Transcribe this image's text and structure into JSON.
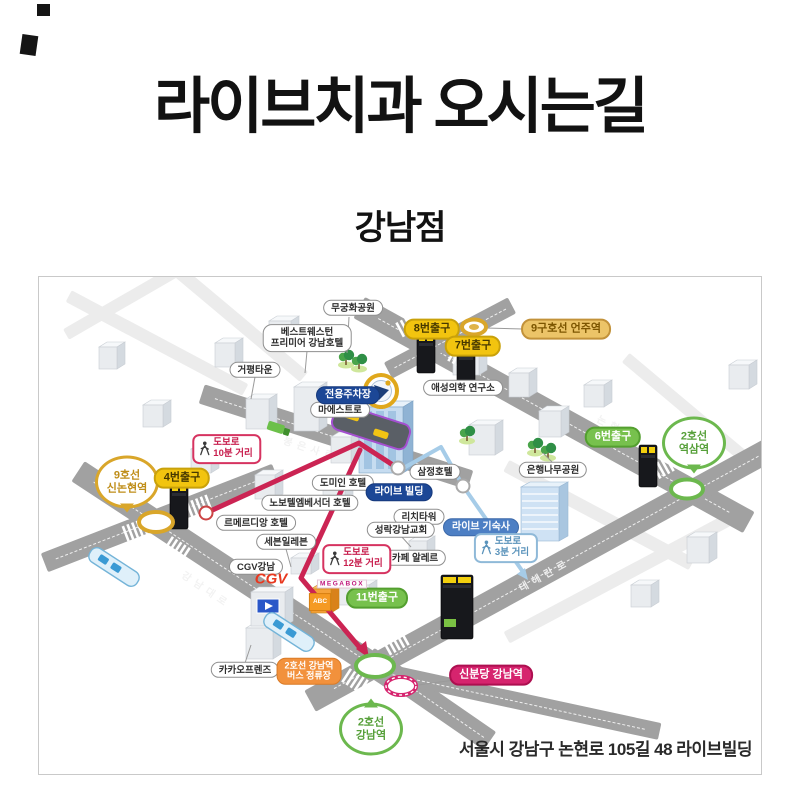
{
  "page": {
    "title": "라이브치과 오시는길",
    "subtitle": "강남점",
    "address": "서울시 강남구 논현로 105길 48 라이브빌딩"
  },
  "colors": {
    "route_primary": "#cb2453",
    "route_secondary": "#a6cce8",
    "road": "#a1a1a1",
    "subway_yellow": "#d9a62a",
    "subway_green": "#6cb84e",
    "subway_magenta": "#d6246e"
  },
  "map": {
    "roads": [
      {
        "id": "nonhyeon-ro",
        "label": "논현로"
      },
      {
        "id": "bongeunsa-ro",
        "label": "봉은사로"
      },
      {
        "id": "gangnam-daero",
        "label": "강남대로"
      },
      {
        "id": "teheran-ro",
        "label": "테헤란로"
      }
    ],
    "stations": [
      {
        "id": "sinnonhyeon",
        "name": "9호선 신논현역",
        "display": "balloon",
        "lines": [
          "9호선",
          "신논현역"
        ],
        "style": "gold",
        "tail": "down"
      },
      {
        "id": "eonju",
        "name": "9구호선 언주역",
        "display": "badge",
        "style": "gold"
      },
      {
        "id": "yeoksam",
        "name": "2호선 역삼역",
        "display": "balloon",
        "lines": [
          "2호선",
          "역삼역"
        ],
        "style": "green",
        "tail": "down"
      },
      {
        "id": "gangnam",
        "name": "2호선 강남역",
        "display": "balloon",
        "lines": [
          "2호선",
          "강남역"
        ],
        "style": "green",
        "tail": "up"
      },
      {
        "id": "sinbundang-gangnam",
        "name": "신분당 강남역",
        "display": "badge",
        "style": "crimson"
      }
    ],
    "exits": [
      {
        "id": "exit-4",
        "label": "4번출구",
        "style": "yellow"
      },
      {
        "id": "exit-8",
        "label": "8번출구",
        "style": "yellow"
      },
      {
        "id": "exit-7",
        "label": "7번출구",
        "style": "yellow"
      },
      {
        "id": "exit-6",
        "label": "6번출구",
        "style": "green"
      },
      {
        "id": "exit-11",
        "label": "11번출구",
        "style": "green"
      }
    ],
    "destination_badges": [
      {
        "id": "parking",
        "label": "전용주차장",
        "style": "navy"
      },
      {
        "id": "live-building",
        "label": "라이브 빌딩",
        "style": "navy"
      },
      {
        "id": "live-dorm",
        "label": "라이브 기숙사",
        "style": "steel"
      }
    ],
    "walk_routes": [
      {
        "id": "walk-10",
        "lines": [
          "도보로",
          "10분 거리"
        ],
        "style": "red"
      },
      {
        "id": "walk-12",
        "lines": [
          "도보로",
          "12분 거리"
        ],
        "style": "red"
      },
      {
        "id": "walk-3",
        "lines": [
          "도보로",
          "3분 거리"
        ],
        "style": "blue"
      }
    ],
    "landmarks": [
      {
        "id": "mugunghwa-park",
        "label": "무궁화공원"
      },
      {
        "id": "best-western",
        "lines": [
          "베스트웨스턴",
          "프리미어 강남호텔"
        ]
      },
      {
        "id": "geopyeong-town",
        "label": "거평타운"
      },
      {
        "id": "maestro",
        "label": "마에스트로"
      },
      {
        "id": "aeseong-lab",
        "label": "애성의학 연구소"
      },
      {
        "id": "dormy-inn",
        "label": "도미인 호텔"
      },
      {
        "id": "novotel",
        "label": "노보텔엠베서더 호텔"
      },
      {
        "id": "le-meridien",
        "label": "르메르디앙 호텔"
      },
      {
        "id": "seven-eleven",
        "label": "세븐일레븐"
      },
      {
        "id": "cgv-gangnam",
        "label": "CGV강남"
      },
      {
        "id": "samjung-hotel",
        "label": "삼정호텔"
      },
      {
        "id": "ginkgo-park",
        "label": "은행나무공원"
      },
      {
        "id": "rich-tower",
        "label": "리치타워"
      },
      {
        "id": "seongnak-church",
        "label": "성락강남교회"
      },
      {
        "id": "cafe-allere",
        "label": "카페 알레르"
      },
      {
        "id": "kakao-friends",
        "label": "카카오프렌즈"
      },
      {
        "id": "gangnam-bus-stop",
        "lines": [
          "2호선 강남역",
          "버스 정류장"
        ],
        "style": "orange"
      }
    ],
    "signs": [
      {
        "id": "cgv-logo",
        "label": "CGV",
        "style": "cgv"
      },
      {
        "id": "megabox",
        "label": "MEGABOX",
        "style": "megabox"
      },
      {
        "id": "abc-mart",
        "label": "ABC",
        "style": "abc"
      }
    ]
  }
}
